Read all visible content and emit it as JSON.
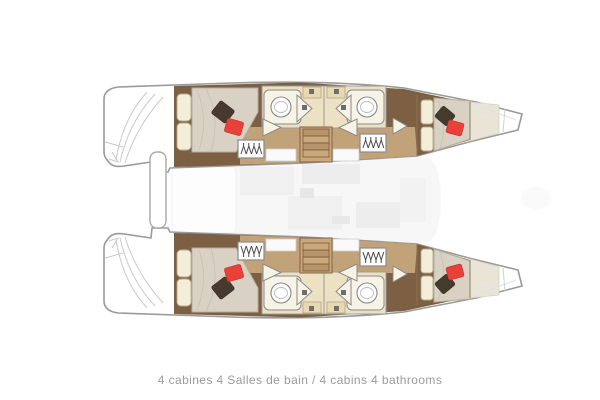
{
  "caption": {
    "full": "4 cabines 4 Salles de bain / 4 cabins 4 bathrooms",
    "french": "4 cabines 4 Salles de bain",
    "english": "4 cabins 4 bathrooms",
    "cabins_count": "4",
    "bathrooms_count": "4"
  },
  "colors": {
    "hull_outline": "#9a9a9a",
    "hull_fill": "#ffffff",
    "wood_dark": "#7d5f44",
    "wood_light": "#c2a379",
    "stair_light": "#c9a87c",
    "stair_dark": "#b8946a",
    "stair_stroke": "#7a5a3c",
    "bath_floor": "#ece1c2",
    "counter_beige": "#e8d9b2",
    "fixture_cream": "#f7f3e6",
    "mattress_greige": "#d9d2c4",
    "pillow_cream": "#f4eed9",
    "pillow_dark_brown": "#463a2f",
    "pillow_red": "#e8413a",
    "saloon_faint": "#f7f7f7",
    "caption_gray": "#9b9b9b",
    "hanger_dark": "#4a4a4a",
    "transom_line": "#c9c9c9"
  }
}
